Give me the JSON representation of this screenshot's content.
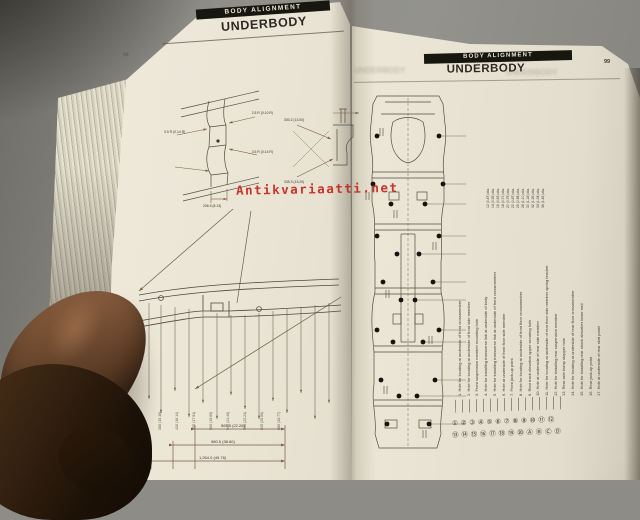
{
  "photo": {
    "watermark_text": "Antikvariaatti.net"
  },
  "left_page": {
    "header_bar_label": "BODY ALIGNMENT",
    "title": "UNDERBODY",
    "page_number": "98",
    "detail1_labels": [
      "3.5 R (0.14 R)",
      "2.5 R (0.10 R)",
      "3.5 R (0.14 R)",
      "206.5 (8.13)"
    ],
    "detail2_labels": [
      "330.2 (13.00)",
      "335.3 (13.20)"
    ],
    "bottom_dims": [
      "565.5 (22.26)",
      "980.5 (38.60)",
      "1,264.0 (49.76)"
    ],
    "diagram_side_labels": [
      "385 (15.16)",
      "410 (16.14)",
      "455 (17.91)",
      "500 (19.69)",
      "545 (21.46)",
      "590 (23.23)",
      "635 (25.00)",
      "680 (26.77)"
    ]
  },
  "right_page": {
    "header_bar_label": "BODY ALIGNMENT",
    "title": "UNDERBODY",
    "page_number": "99",
    "dims_column": [
      "12 (0.47) dia.",
      "14 (0.55) dia.",
      "16 (0.63) dia.",
      "18 (0.71) dia.",
      "20 (0.79) dia.",
      "22 (0.87) dia.",
      "25 (0.98) dia.",
      "28 (1.10) dia.",
      "30 (1.18) dia.",
      "32 (1.26) dia.",
      "34 (1.34) dia.",
      "36 (1.42) dia."
    ],
    "notes": [
      "1. Hole for locating at underside of front crossmember",
      "2. Hole for locating at underside of front side member",
      "3. Front suspension member mounting hole",
      "4. Hole for installing transverse link at underside of body",
      "5. Hole for installing transverse link at underside of front crossmember",
      "6. Hole at underside of front floor side member",
      "7. Front jack-up point",
      "8. Hole for locating at underside of front floor crossmember",
      "9. Rear track elevation upper securing hole",
      "10. Hole at underside of rear side member",
      "11. Hole for locating at underside of rear floor side member spring bracket",
      "12. Hole for installing rear suspension member",
      "13. Rear axle bump stopper hole",
      "14. Hole for locating at underside of rear floor crossmember",
      "15. Hole for installing rear shock absorber lower end",
      "16. Rear jack-up point",
      "17. Hole at underside of rear skirt panel"
    ],
    "legend_row1": "① ② ③ ④ ⑤ ⑥ ⑦ ⑧ ⑨ ⑩ ⑪ ⑫",
    "legend_row2": "⑬ ⑭ ⑮ ⑯ ⑰ ⑱ ⑲ ⑳ Ⓐ Ⓑ Ⓒ Ⓓ"
  }
}
